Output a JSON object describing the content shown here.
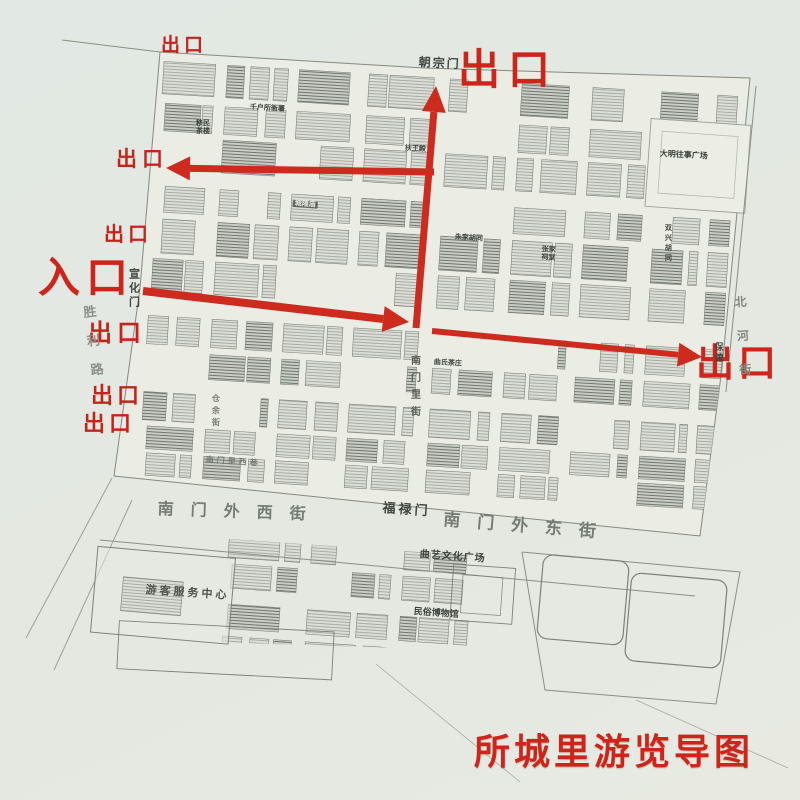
{
  "title": "所城里游览导图",
  "legend": {
    "entrance": "入口",
    "exit": "出口"
  },
  "gates": {
    "north": "朝宗门",
    "west": "宣化门",
    "south": "福禄门",
    "east": "保德"
  },
  "streets": {
    "south_outer_west": "南门外西街",
    "south_outer_east": "南门外东街",
    "nanmenli": "南门里街",
    "nanmenli_west_alley": "南门里西巷",
    "cangyu": "仓余街",
    "beihe": "北河街",
    "shengli": "胜利路"
  },
  "pois": {
    "visitor_center": "游客服务中心",
    "quyi_square": "曲艺文化广场",
    "folk_museum": "民俗博物馆",
    "daming_square": "大明往事广场",
    "qianhusuo_office": "千户所衙署",
    "chenghuang_temple": "城隍庙",
    "zhujia_hutong": "朱家胡同",
    "zhangjia_temple": "张家祠堂",
    "shuangxing_hutong": "双兴胡同",
    "fuwang_hall": "扶王殿",
    "qushi_teahouse": "曲氏茶庄",
    "yimin_teahouse": "移民茶楼"
  },
  "colors": {
    "route_red": "#ce2b1f",
    "label_red": "#c6241b",
    "title_red": "#d02417",
    "map_ink": "#6f746d",
    "paper": "#ecede5"
  }
}
